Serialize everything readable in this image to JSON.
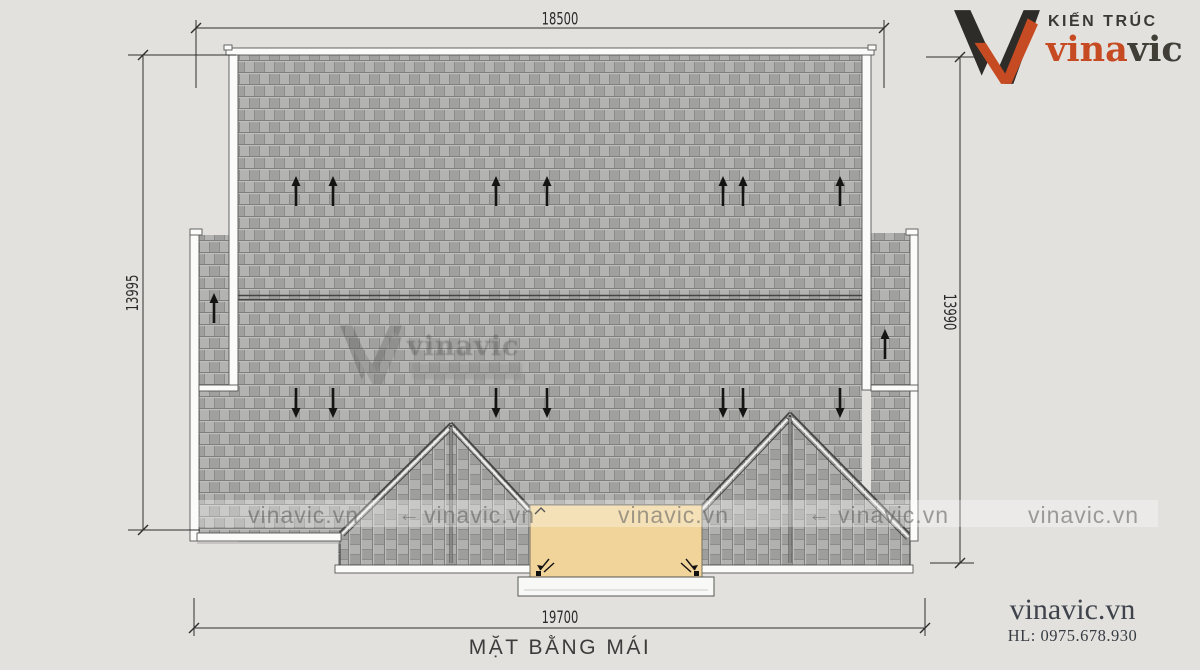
{
  "title": {
    "text": "MẶT BẰNG MÁI"
  },
  "dimensions": {
    "top": "18500",
    "left": "13995",
    "right": "13990",
    "bottom": "19700"
  },
  "logo": {
    "tagline": "KIẾN TRÚC",
    "brand_primary": "vina",
    "brand_secondary": "vic",
    "accent_color": "#c64a22",
    "dark_color": "#2d2c28"
  },
  "contact": {
    "website": "vinavic.vn",
    "hotline": "HL: 0975.678.930"
  },
  "watermark": {
    "url_text": "vinavic.vn",
    "brand_text": "vinavic",
    "arrow_glyph": "←"
  },
  "drawing": {
    "background_color": "#e3e1de",
    "roof_shingle_color": "#a9a9a7",
    "balcony_color": "#f1d49a",
    "fascia_color": "#fbfbf9"
  }
}
